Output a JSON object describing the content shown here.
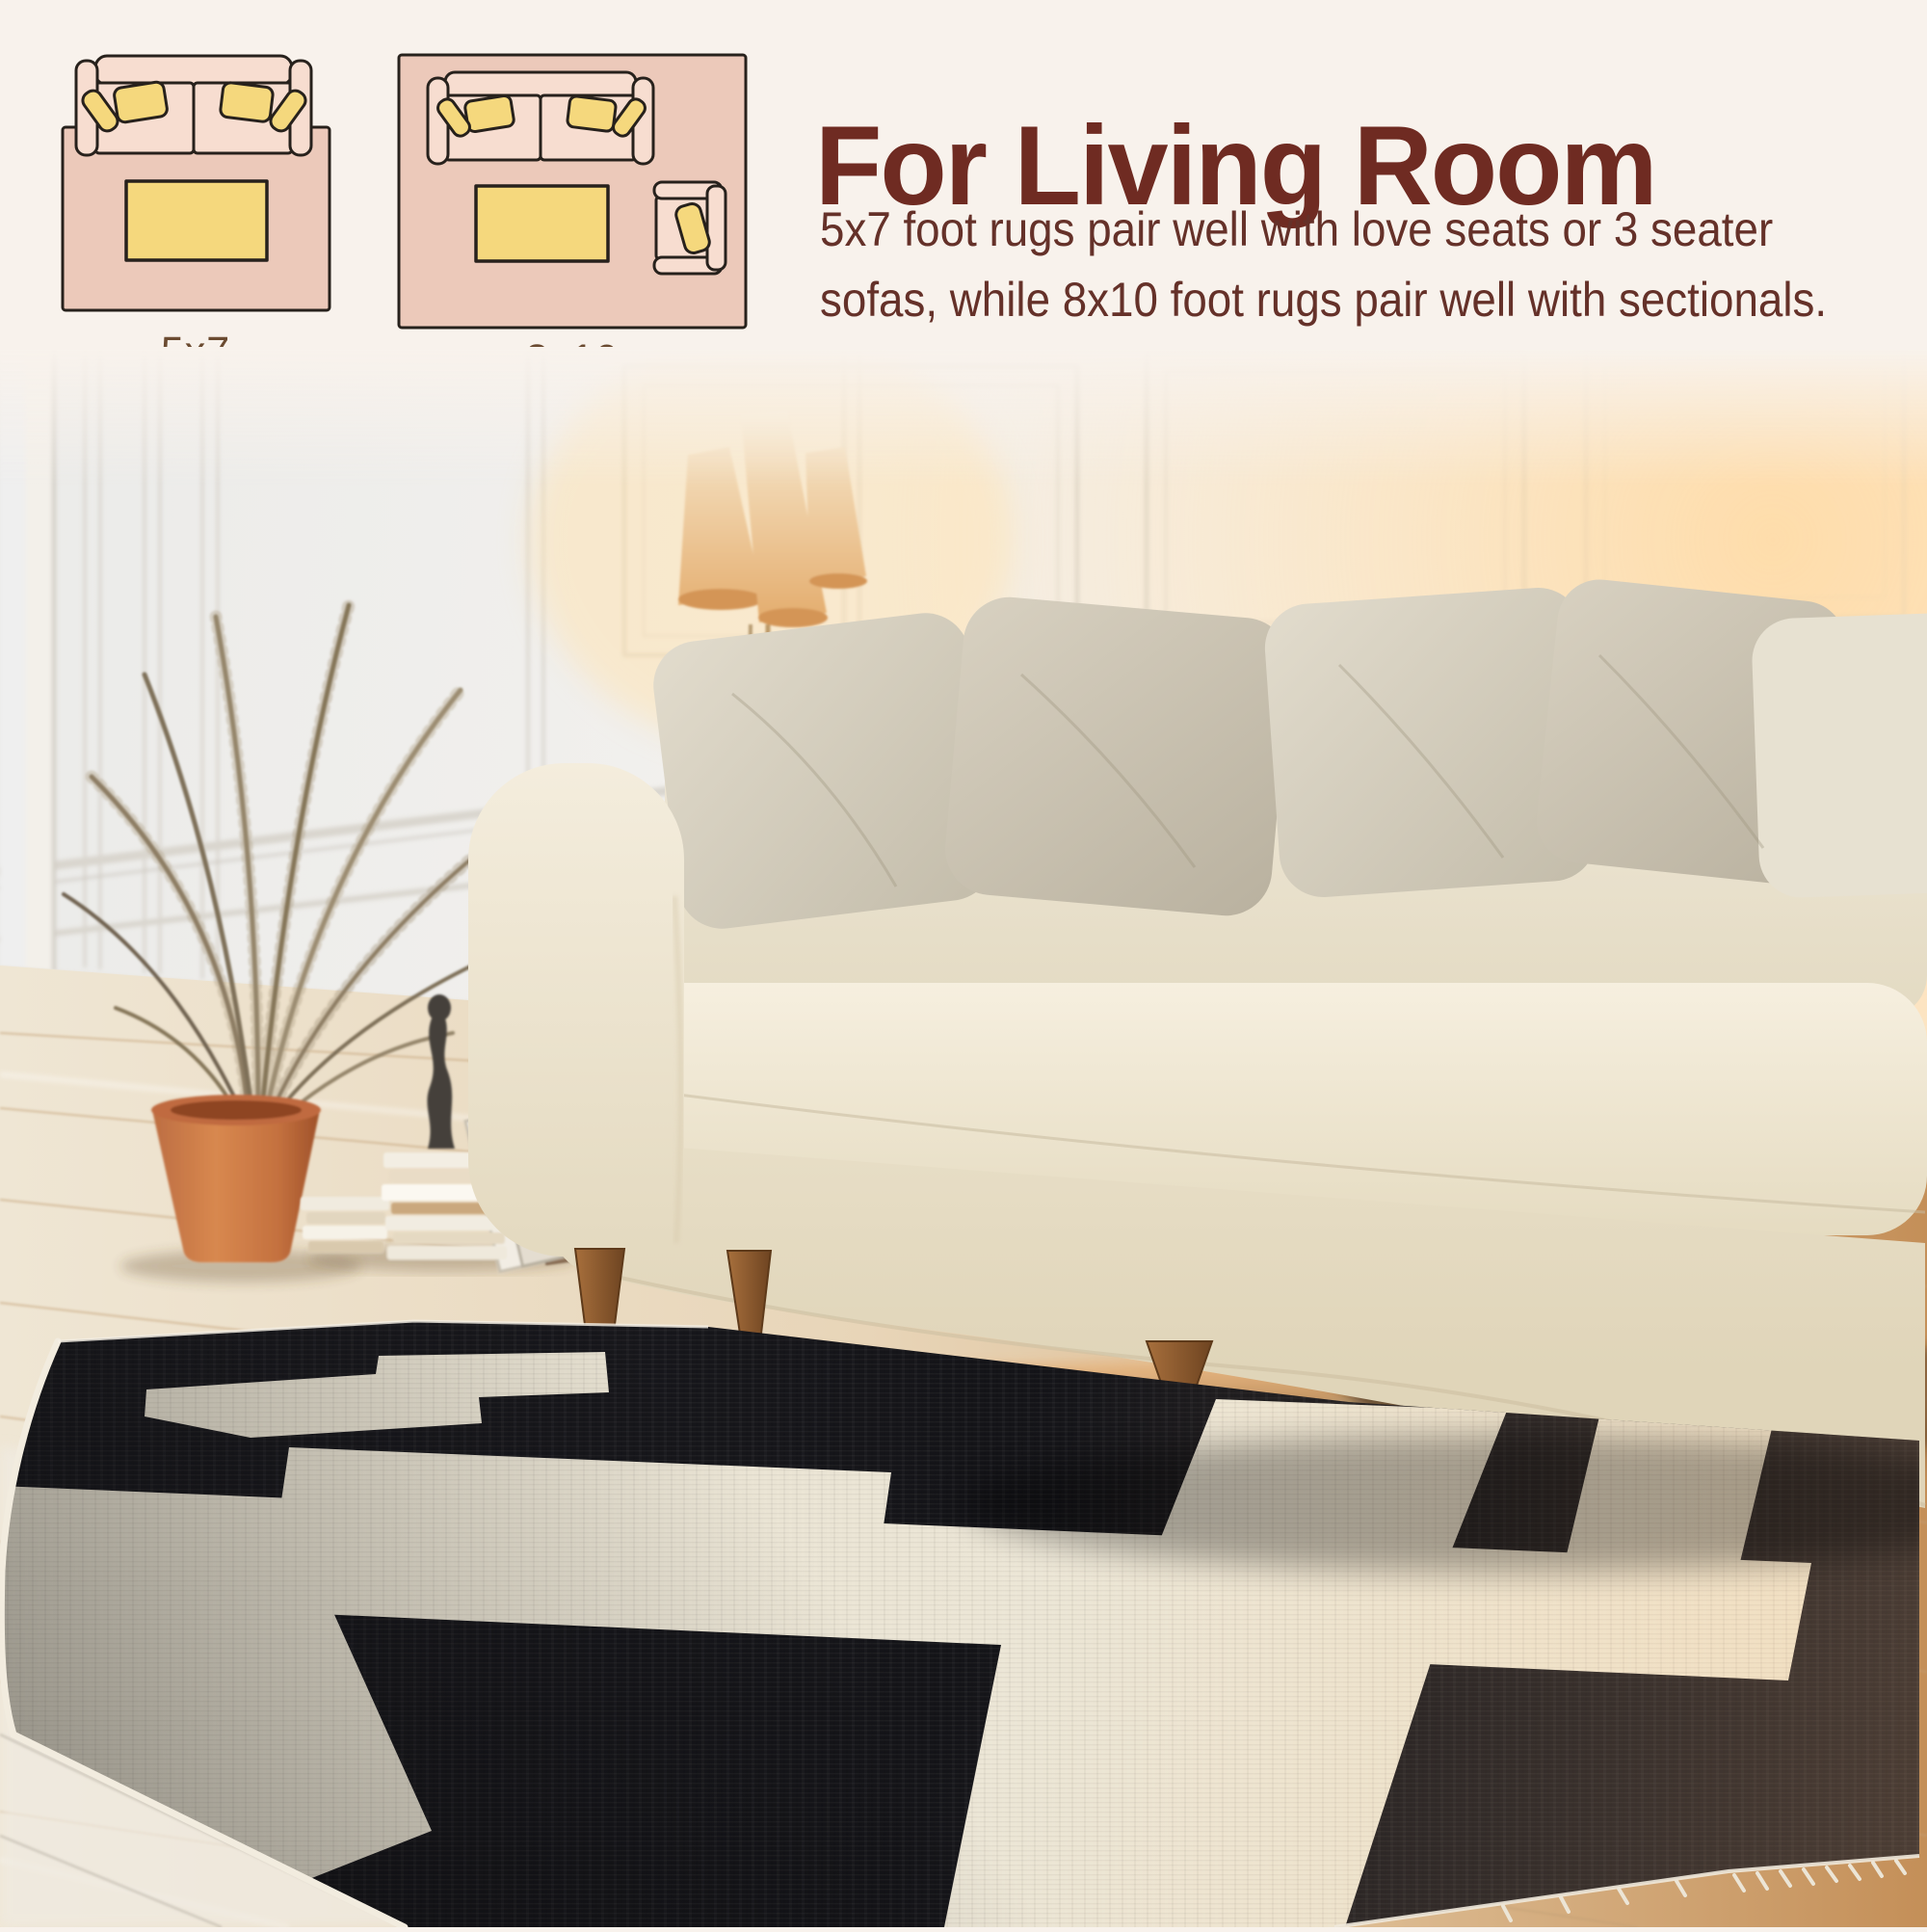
{
  "header": {
    "title": "For Living Room",
    "description_lines": [
      "5x7 foot rugs pair well with love seats or 3 seater",
      "sofas, while 8x10 foot rugs pair well with sectionals."
    ]
  },
  "diagrams": [
    {
      "name": "rug-5x7-diagram",
      "label": "5x7"
    },
    {
      "name": "rug-8x10-diagram",
      "label": "8x10"
    }
  ],
  "scene_icons": [
    "wall-paneling",
    "floor-lamp-icon",
    "palm-plant-icon",
    "terracotta-pot-icon",
    "book-stack-icon",
    "leaning-frames-icon",
    "vase-icon",
    "sofa-icon",
    "throw-pillows-icon",
    "wood-floor",
    "area-rug-icon",
    "rug-fringe-icon"
  ],
  "colors": {
    "background": "#f8f2ec",
    "title_color": "#6f2b22",
    "body_text": "#653129",
    "label_color": "#6b4b31",
    "diagram_rug_pink": "#ecc9ba",
    "diagram_sofa_pink": "#f7ddd0",
    "diagram_accent_yellow": "#f5d87d",
    "diagram_outline": "#27211c",
    "rug_black": "#17171b",
    "rug_cream": "#eae4d3",
    "pot_terracotta": "#c8714a"
  }
}
